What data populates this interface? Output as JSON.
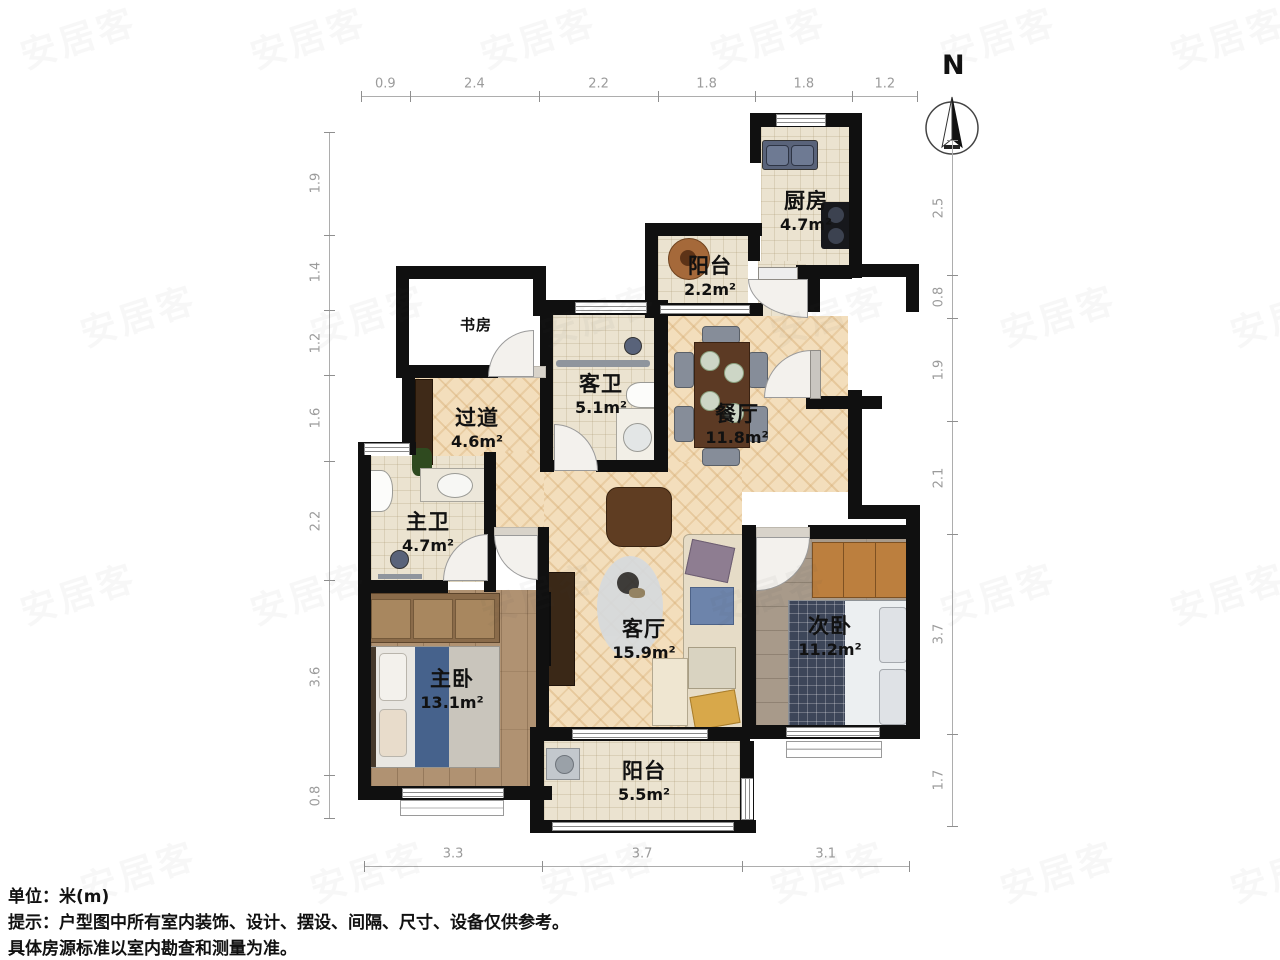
{
  "footer": {
    "unit_line": "单位：米(m)",
    "tip_line1": "提示：户型图中所有室内装饰、设计、摆设、间隔、尺寸、设备仅供参考。",
    "tip_line2": "具体房源标准以室内勘查和测量为准。"
  },
  "compass": {
    "label": "N"
  },
  "watermark": {
    "text": "安居客"
  },
  "rulers": {
    "top": {
      "values": [
        "0.9",
        "2.4",
        "2.2",
        "1.8",
        "1.8",
        "1.2"
      ]
    },
    "bottom": {
      "values": [
        "3.3",
        "3.7",
        "3.1"
      ]
    },
    "left": {
      "values": [
        "1.9",
        "1.4",
        "1.2",
        "1.6",
        "2.2",
        "3.6",
        "0.8"
      ]
    },
    "right": {
      "values": [
        "2.5",
        "0.8",
        "1.9",
        "2.1",
        "3.7",
        "1.7"
      ]
    }
  },
  "rooms": [
    {
      "id": "kitchen",
      "name": "厨房",
      "area": "4.7m²"
    },
    {
      "id": "balcony-top",
      "name": "阳台",
      "area": "2.2m²"
    },
    {
      "id": "study",
      "name": "书房",
      "area": ""
    },
    {
      "id": "guest-bath",
      "name": "客卫",
      "area": "5.1m²"
    },
    {
      "id": "corridor",
      "name": "过道",
      "area": "4.6m²"
    },
    {
      "id": "dining",
      "name": "餐厅",
      "area": "11.8m²"
    },
    {
      "id": "master-bath",
      "name": "主卫",
      "area": "4.7m²"
    },
    {
      "id": "master-bedroom",
      "name": "主卧",
      "area": "13.1m²"
    },
    {
      "id": "living",
      "name": "客厅",
      "area": "15.9m²"
    },
    {
      "id": "second-bedroom",
      "name": "次卧",
      "area": "11.2m²"
    },
    {
      "id": "balcony-bottom",
      "name": "阳台",
      "area": "5.5m²"
    }
  ],
  "colors": {
    "wall": "#101010",
    "tile_floor": "#ebe3d0",
    "wood_floor_master": "#b09272",
    "wood_floor_second": "#a89a8a",
    "herringbone_floor": "#f3debc",
    "dim_text": "#9b9b9b"
  }
}
